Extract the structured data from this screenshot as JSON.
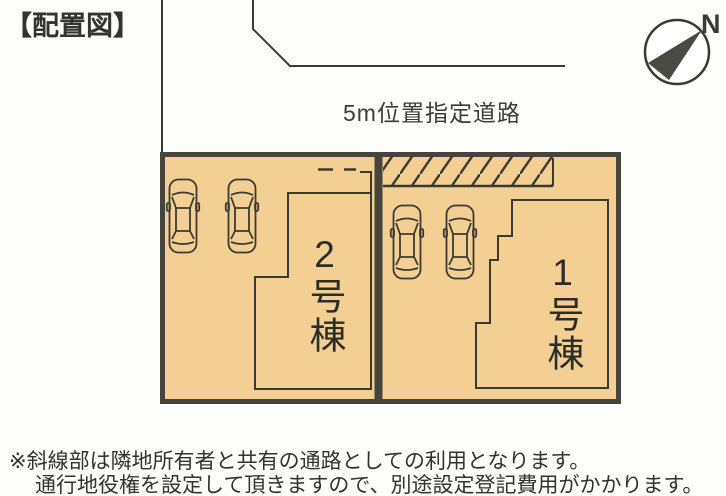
{
  "title": "【配置図】",
  "compass": {
    "label": "N",
    "icon": "north-compass-icon"
  },
  "road_label": "5m位置指定道路",
  "buildings": [
    {
      "label": "2号棟"
    },
    {
      "label": "1号棟"
    }
  ],
  "parking": {
    "car_icon": "car-top-view-icon",
    "cars_lot2": 2,
    "cars_lot1": 2
  },
  "hatched_area": {
    "meaning": "斜線部（共有通路）"
  },
  "notes": {
    "line1": "※斜線部は隣地所有者と共有の通路としての利用となります。",
    "line2": "通行地役権を設定して頂きますので、別途設定登記費用がかかります。"
  },
  "colors": {
    "plot_fill": "#f3cf94",
    "plot_border": "#45453b",
    "line_color": "#3a3a32",
    "text_color": "#2f2f2b",
    "needle_fill": "#4a4a44"
  }
}
